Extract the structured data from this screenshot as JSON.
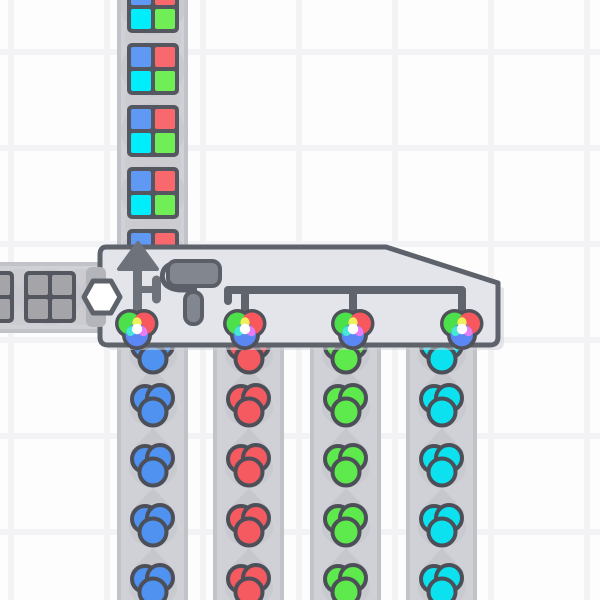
{
  "scene": {
    "description": "factory game scene: quad painter machine with one uncolored shape supply belt, four color supply belts and one painted shape output belt",
    "machine": {
      "name": "quad painter",
      "output_direction": "up",
      "shape_input": "hexagon slot, left side",
      "color_inputs": 4,
      "icons": [
        "up-arrow",
        "paint-roller",
        "color-input-pipe",
        "color-wheel x4"
      ]
    },
    "belts": {
      "output_belt": {
        "direction": "up",
        "item_type": "painted-shape",
        "quadrants": [
          "blue",
          "red",
          "cyan",
          "green"
        ],
        "visible_items": 5
      },
      "shape_supply_belt": {
        "direction": "right",
        "item_type": "uncolored-shape",
        "quadrants": [
          "uncolored",
          "uncolored",
          "uncolored",
          "uncolored"
        ],
        "visible_items": 3
      },
      "color_supply_belts": [
        {
          "color": "blue",
          "direction": "up",
          "visible_items": 5
        },
        {
          "color": "red",
          "direction": "up",
          "visible_items": 5
        },
        {
          "color": "green",
          "direction": "up",
          "visible_items": 5
        },
        {
          "color": "cyan",
          "direction": "up",
          "visible_items": 5
        }
      ]
    }
  },
  "palette": {
    "background": "#fdfdfe",
    "grid_line": "#f3f3f6",
    "belt": "#d0d1d6",
    "belt_rail": "#c2c3c8",
    "belt_mark": "#c6c7cc",
    "outline_dark": "#54575f",
    "machine_fill": "#e3e5ea",
    "machine_outline": "#5e626b",
    "machine_shadow": "#d2d3d8",
    "icon_gray": "#6e727b",
    "roller_gray": "#82868f",
    "roller_outline": "#5b5f68",
    "pipe_gray": "#60646d",
    "tab_gray": "#b3b5bb",
    "shape_blue": "#5f99f3",
    "shape_red": "#f9686c",
    "shape_cyan": "#00eefb",
    "shape_green": "#70ee56",
    "shape_uncolored": "#a5a5a9",
    "paint_blue": "#4f92f0",
    "paint_red": "#f55a61",
    "paint_green": "#5ee94c",
    "paint_cyan": "#0ce2ef",
    "wheel_green": "#4ce14a",
    "wheel_red": "#f8575e",
    "wheel_blue": "#5b87f5",
    "wheel_yellow": "#eef05c",
    "wheel_cyan": "#45e7d8",
    "wheel_magenta": "#e57cf3",
    "wheel_center": "#ffffff",
    "wheel_outline": "#4f525a"
  }
}
